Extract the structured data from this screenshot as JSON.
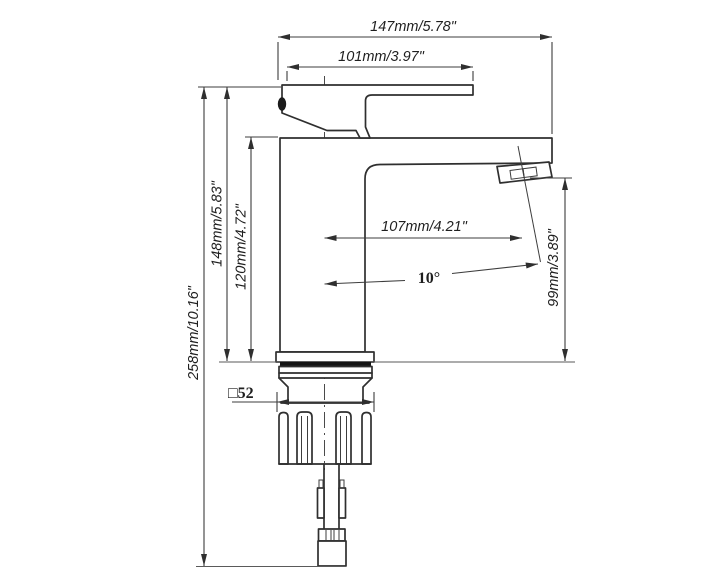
{
  "drawing": {
    "type": "technical-drawing",
    "subject": "single-handle basin faucet side elevation with dimension annotations",
    "background_color": "#ffffff",
    "line_color": "#2f2f2f",
    "gasket_color": "#141414",
    "dimensions": {
      "overall_width": "147mm/5.78\"",
      "handle_length": "101mm/3.97\"",
      "overall_height": "258mm/10.16\"",
      "height_to_handle_top": "148mm/5.83\"",
      "height_to_spout_top": "120mm/4.72\"",
      "spout_reach": "107mm/4.21\"",
      "outlet_angle": "10°",
      "outlet_height": "99mm/3.89\"",
      "base_plate_size": "□52"
    }
  }
}
